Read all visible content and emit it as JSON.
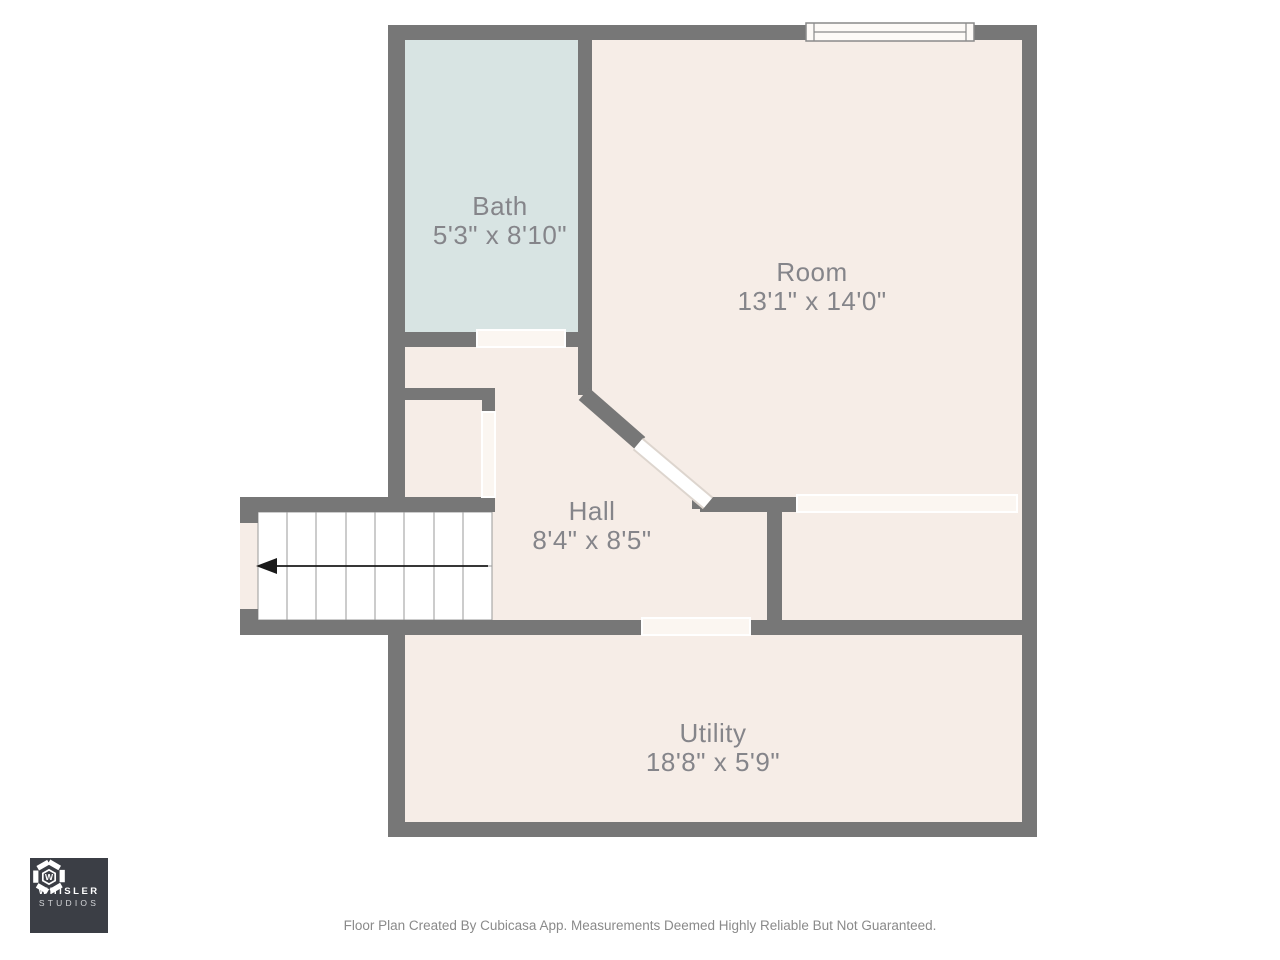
{
  "floor_plan": {
    "rooms": [
      {
        "name": "Bath",
        "dimensions": "5'3\" x 8'10\"",
        "floor_color": "#d8e4e3"
      },
      {
        "name": "Room",
        "dimensions": "13'1\" x 14'0\"",
        "floor_color": "#f6ede7"
      },
      {
        "name": "Hall",
        "dimensions": "8'4\" x 8'5\"",
        "floor_color": "#f6ede7"
      },
      {
        "name": "Utility",
        "dimensions": "18'8\" x 5'9\"",
        "floor_color": "#f6ede7"
      }
    ],
    "features": {
      "staircase": {
        "tread_columns": 8,
        "rows": 2,
        "arrow_direction": "left"
      },
      "windows": 1,
      "door_openings": [
        "bath-to-hall",
        "hall-closet",
        "room-diagonal-door",
        "room-to-closet-opening",
        "hall-to-utility"
      ]
    },
    "colors": {
      "wall": "#777777",
      "floor": "#f6ede7",
      "bath_floor": "#d8e4e3",
      "label_text": "#85858a",
      "background": "#ffffff",
      "stair_tread": "#ffffff"
    }
  },
  "branding": {
    "logo_line1": "WHISLER",
    "logo_line2": "STUDIOS",
    "logo_background": "#3b3e45"
  },
  "footer": {
    "disclaimer": "Floor Plan Created By Cubicasa App. Measurements Deemed Highly Reliable But Not Guaranteed."
  }
}
